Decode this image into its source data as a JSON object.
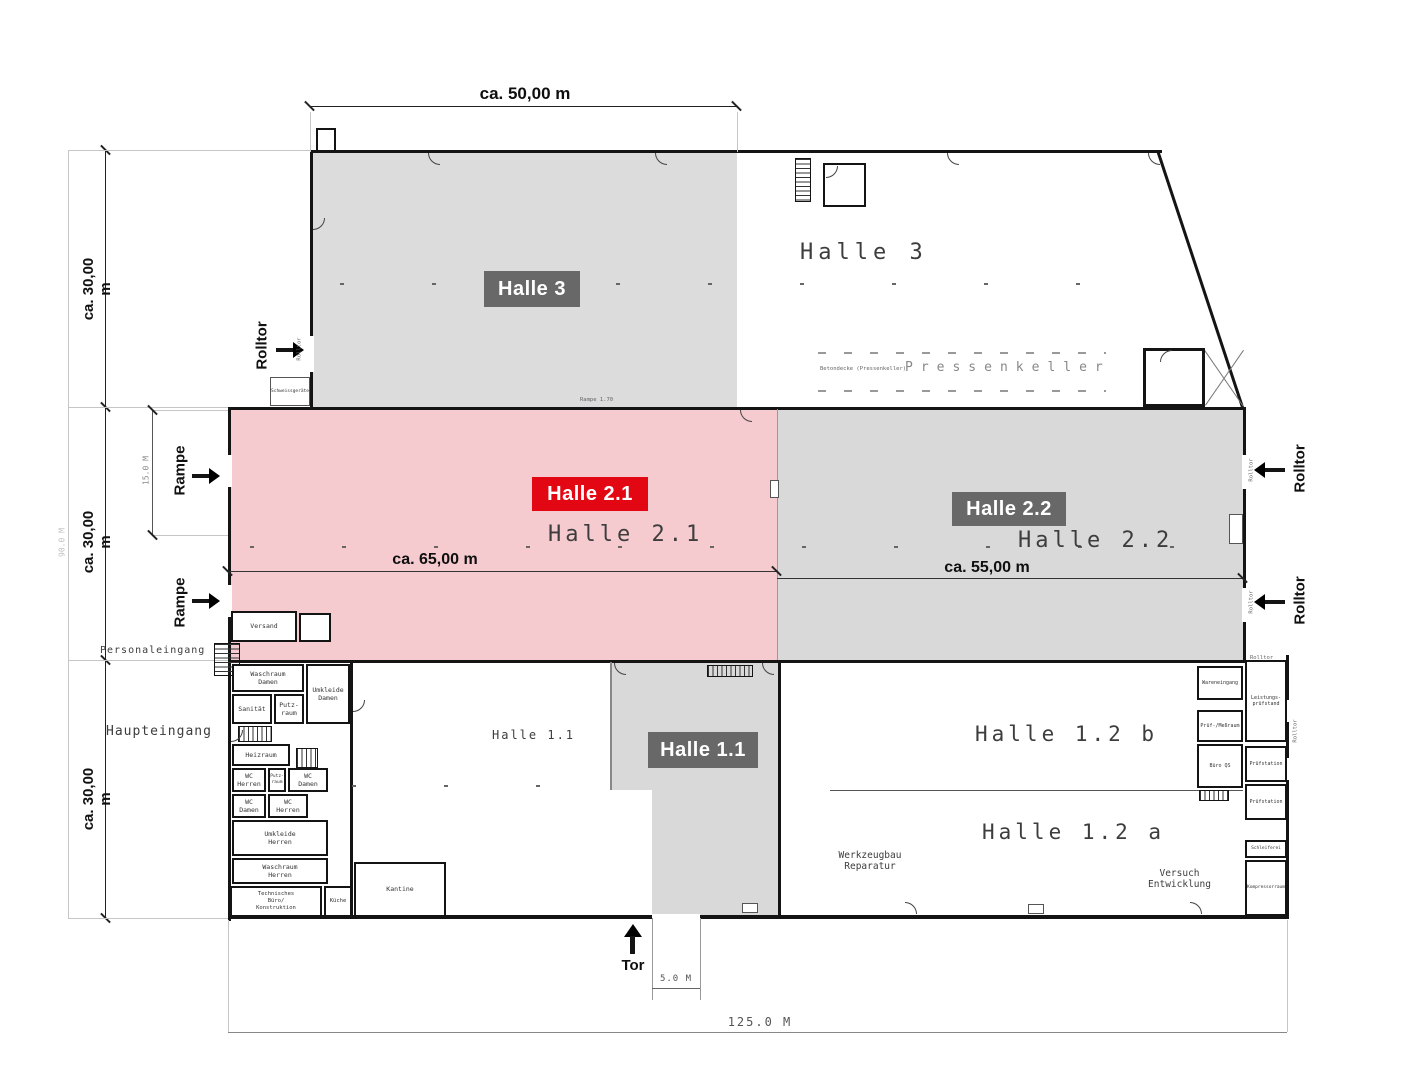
{
  "dims": {
    "top_width": "ca. 50,00 m",
    "left": [
      "ca. 30,00 m",
      "ca. 30,00 m",
      "ca. 30,00 m"
    ],
    "left_total": "90.0 M",
    "h21_width": "ca. 65,00 m",
    "h22_width": "ca. 55,00 m",
    "rampe_height": "15.0 M",
    "tor_width": "5.0 M",
    "total_width": "125.0 M"
  },
  "colors": {
    "accent_red": "#e30613",
    "badge_gray": "#686868",
    "fill_pink": "#f6cbcf",
    "fill_gray": "#d9d9d9"
  },
  "halls": {
    "h3": {
      "badge": "Halle 3",
      "script": "Halle 3"
    },
    "h21": {
      "badge": "Halle 2.1",
      "script": "Halle 2.1"
    },
    "h22": {
      "badge": "Halle 2.2",
      "script": "Halle 2.2"
    },
    "h11": {
      "badge": "Halle 1.1",
      "script": "Halle 1.1"
    },
    "h12b": {
      "script": "Halle 1.2 b"
    },
    "h12a": {
      "script": "Halle 1.2 a"
    }
  },
  "callouts": {
    "rolltor": "Rolltor",
    "rampe": "Rampe",
    "tor": "Tor",
    "haupteingang": "Haupteingang",
    "personaleingang": "Personaleingang"
  },
  "areas": {
    "pressenkeller": "Pressenkeller",
    "betondecke": "Betondecke (Pressenkeller)",
    "werkzeugbau": "Werkzeugbau\nReparatur",
    "versuch": "Versuch\nEntwicklung"
  },
  "rooms": {
    "waschraum_damen": "Waschraum\nDamen",
    "umkleide_damen": "Umkleide\nDamen",
    "sanitaet": "Sanität",
    "putzraum_klein": "Putz-\nraum",
    "heizraum": "Heizraum",
    "wc_herren_1": "WC\nHerren",
    "putzraum": "Putz-\nraum",
    "wc_damen_1": "WC\nDamen",
    "wc_damen_2": "WC\nDamen",
    "wc_herren_2": "WC\nHerren",
    "umkleide_herren": "Umkleide\nHerren",
    "waschraum_herren": "Waschraum\nHerren",
    "techn_buero": "Technisches\nBüro/\nKonstruktion",
    "kueche": "Küche",
    "kantine": "Kantine",
    "versand": "Versand",
    "schweissgeraete": "Schweissgeräte",
    "rampe_170": "Rampe 1.70",
    "wareneingang": "Wareneingang",
    "leistungspruefstand": "Leistungs-\nprüfstand",
    "pruef_messraum": "Prüf-/Meßraum",
    "buero_qs": "Büro QS",
    "pruefstation_1": "Prüfstation",
    "pruefstation_2": "Prüfstation",
    "schleiferei": "Schleiferei",
    "kompressorraum": "Kompressorraum"
  }
}
